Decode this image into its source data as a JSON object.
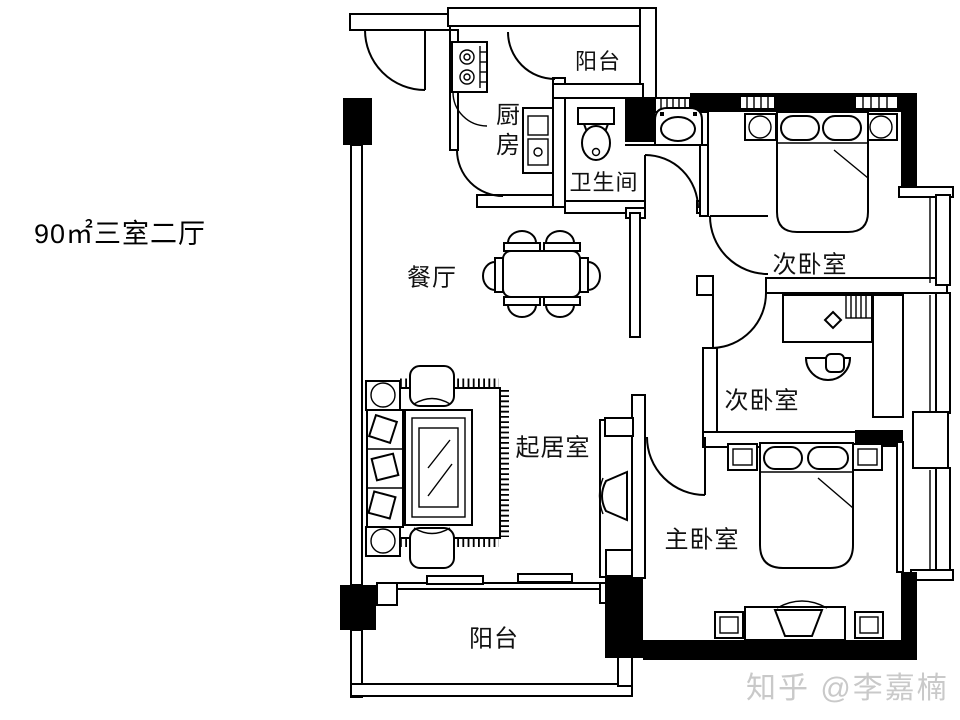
{
  "title": "90㎡三室二厅",
  "watermark": "知乎 @李嘉楠",
  "rooms": {
    "kitchen": {
      "label": "厨房"
    },
    "balcony_top": {
      "label": "阳台"
    },
    "bathroom": {
      "label": "卫生间"
    },
    "bedroom_second_top": {
      "label": "次卧室"
    },
    "bedroom_second_mid": {
      "label": "次卧室"
    },
    "master_bedroom": {
      "label": "主卧室"
    },
    "dining_room": {
      "label": "餐厅"
    },
    "living_room": {
      "label": "起居室"
    },
    "balcony_bottom": {
      "label": "阳台"
    }
  },
  "colors": {
    "wall": "#000000",
    "background": "#ffffff",
    "watermark": "#c9c9c9"
  }
}
